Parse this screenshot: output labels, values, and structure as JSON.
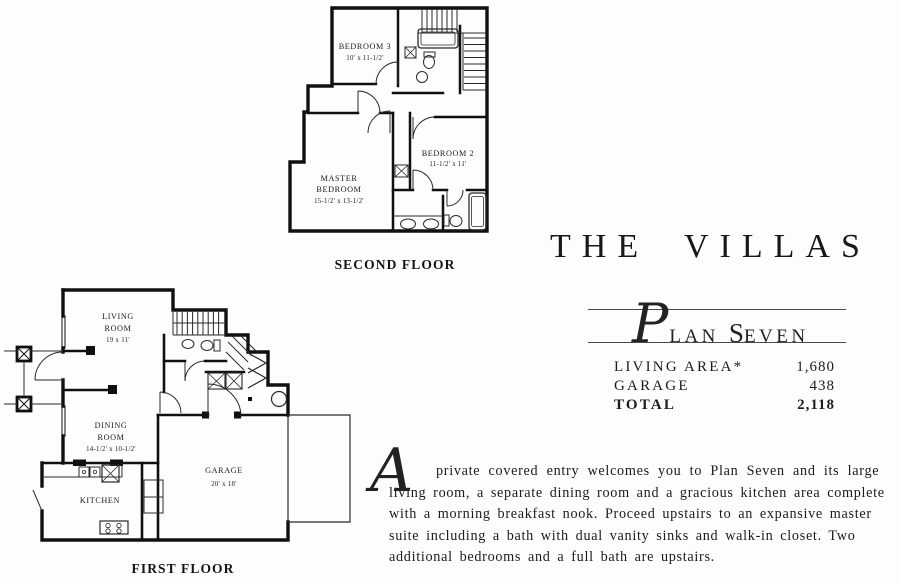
{
  "title_block": {
    "title": "THE VILLAS",
    "plan_initial": "P",
    "plan_rest": "LAN",
    "plan_s": "S",
    "plan_even": "EVEN"
  },
  "stats": {
    "rows": [
      {
        "label": "LIVING AREA*",
        "value": "1,680"
      },
      {
        "label": "GARAGE",
        "value": "438"
      },
      {
        "label": "TOTAL",
        "value": "2,118"
      }
    ]
  },
  "description": {
    "initial": "A",
    "lines": [
      "private covered entry welcomes you to Plan Seven and its large",
      "living room, a separate dining room and a gracious kitchen area complete",
      "with a morning breakfast nook. Proceed upstairs to an expansive master",
      "suite including a bath with dual vanity sinks and walk-in closet. Two",
      "additional bedrooms and a full bath are upstairs."
    ]
  },
  "second_floor": {
    "caption": "SECOND FLOOR",
    "bedroom3_name": "BEDROOM 3",
    "bedroom3_dims": "10' x 11-1/2'",
    "bedroom2_name": "BEDROOM 2",
    "bedroom2_dims": "11-1/2' x 11'",
    "master_name_line1": "MASTER",
    "master_name_line2": "BEDROOM",
    "master_dims": "15-1/2' x 13-1/2'"
  },
  "first_floor": {
    "caption": "FIRST FLOOR",
    "living_name_line1": "LIVING",
    "living_name_line2": "ROOM",
    "living_dims": "19 x 11'",
    "dining_name_line1": "DINING",
    "dining_name_line2": "ROOM",
    "dining_dims": "14-1/2' x 10-1/2'",
    "kitchen_name": "KITCHEN",
    "garage_name": "GARAGE",
    "garage_dims": "20' x 18'"
  }
}
